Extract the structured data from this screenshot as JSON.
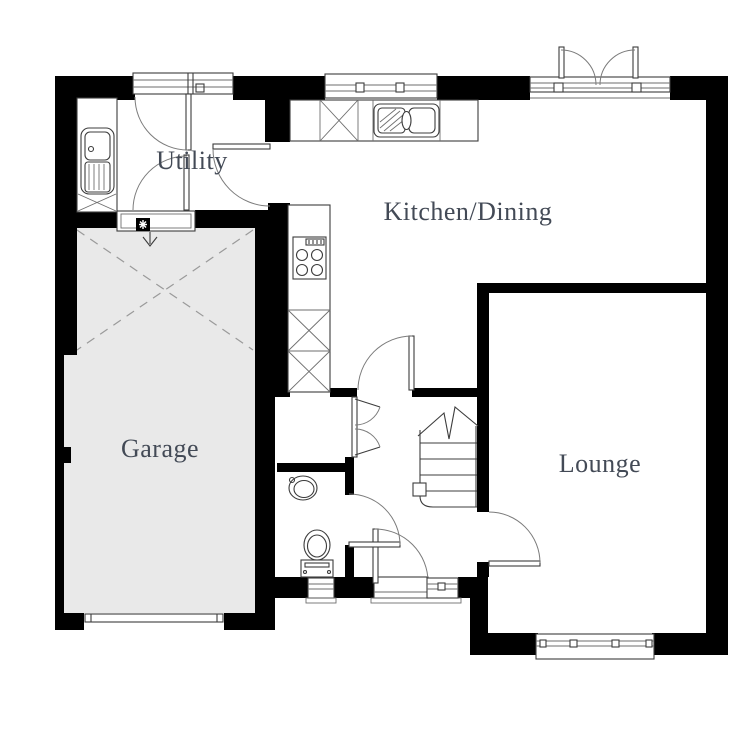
{
  "rooms": {
    "utility": {
      "label": "Utility"
    },
    "kitchen_dining": {
      "label": "Kitchen/Dining"
    },
    "garage": {
      "label": "Garage"
    },
    "lounge": {
      "label": "Lounge"
    }
  },
  "colors": {
    "wall": "#000000",
    "garage_fill": "#e9e9e9",
    "room_label": "#434a56",
    "fixture_line": "#3c3c3c",
    "dashed_line": "#9a9a9a",
    "background": "#ffffff"
  },
  "fixtures": {
    "utility": [
      "utility-worktop",
      "utility-sink",
      "back-door",
      "utility-kitchen-door",
      "garage-access-door",
      "fire-door-symbol",
      "step-down-arrow"
    ],
    "kitchen": [
      "kitchen-worktop",
      "appliance-space",
      "kitchen-sink",
      "kitchen-window",
      "french-doors",
      "hob",
      "tall-units",
      "kitchen-door"
    ],
    "hall": [
      "storage-cupboard-doors",
      "stairs",
      "front-door",
      "front-window"
    ],
    "wc": [
      "wc-door",
      "wash-basin",
      "toilet",
      "wc-window"
    ],
    "lounge": [
      "lounge-door",
      "lounge-window"
    ],
    "garage": [
      "garage-void-cross",
      "garage-door"
    ]
  }
}
